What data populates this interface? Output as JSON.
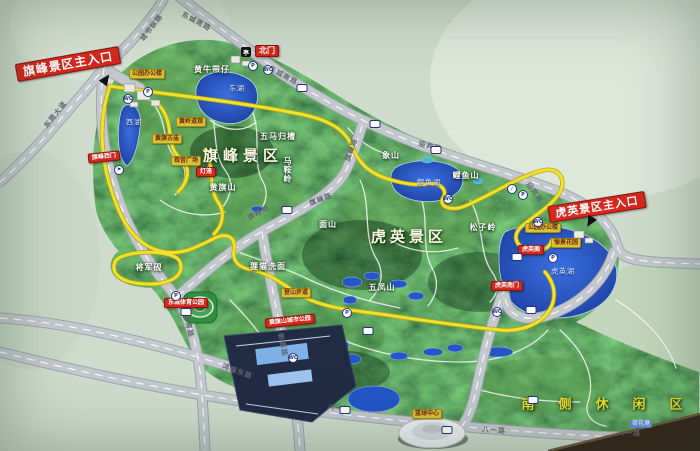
{
  "colors": {
    "background": "#cfdccd",
    "terrain_dark": "#14381a",
    "terrain_mid": "#2b6230",
    "lake_blue": "#2456c8",
    "road_grey": "#c3c8cd",
    "route_yellow": "#efe22a",
    "label_red": "#d3291f",
    "label_yellow": "#d9c233",
    "title_yellow": "#e9dc2e"
  },
  "region_titles": [
    {
      "name": "qifeng-scenic-area-title",
      "text": "旗峰景区",
      "x": 243,
      "y": 156,
      "size": 15,
      "spacing": 5
    },
    {
      "name": "huying-scenic-area-title",
      "text": "虎英景区",
      "x": 409,
      "y": 237,
      "size": 15,
      "spacing": 4
    },
    {
      "name": "south-leisure-area-title",
      "text": "南侧休闲区",
      "x": 614,
      "y": 405,
      "size": 13,
      "spacing": 24,
      "color": "#e9dc2e"
    }
  ],
  "entrance_labels": [
    {
      "name": "qifeng-main-entrance-label",
      "text": "旗峰景区主入口",
      "x": 68,
      "y": 64,
      "size": 12,
      "rot": -10,
      "big": true
    },
    {
      "name": "north-gate-label",
      "text": "北门",
      "x": 267,
      "y": 51,
      "size": 8
    },
    {
      "name": "qifeng-west-gate-label",
      "text": "旗峰西门",
      "x": 104,
      "y": 157,
      "size": 6,
      "rot": -6
    },
    {
      "name": "dongcheng-sports-park-label",
      "text": "东城体育公园",
      "x": 186,
      "y": 303,
      "size": 6
    },
    {
      "name": "huangqishan-city-park-label",
      "text": "黄旗山城市公园",
      "x": 290,
      "y": 321,
      "size": 6,
      "rot": -6
    },
    {
      "name": "huying-main-entrance-label",
      "text": "虎英景区主入口",
      "x": 597,
      "y": 207,
      "size": 11,
      "rot": -9,
      "big": true
    },
    {
      "name": "huying-south-gate-label",
      "text": "虎英南门",
      "x": 507,
      "y": 286,
      "size": 6
    },
    {
      "name": "huying-pavilion-label",
      "text": "虎英阁",
      "x": 531,
      "y": 250,
      "size": 6
    },
    {
      "name": "lantern-label",
      "text": "灯笼",
      "x": 206,
      "y": 172,
      "size": 6
    }
  ],
  "poi_labels": [
    {
      "name": "park-office-label",
      "text": "公园办公楼",
      "x": 147,
      "y": 74
    },
    {
      "name": "huangling-taoist-temple-label",
      "text": "黄岭道观",
      "x": 191,
      "y": 122
    },
    {
      "name": "huangqi-old-temple-label",
      "text": "黄旗古庙",
      "x": 167,
      "y": 139
    },
    {
      "name": "guanyin-square-label",
      "text": "观音广场",
      "x": 186,
      "y": 161
    },
    {
      "name": "hiking-trail-label",
      "text": "登山步道",
      "x": 296,
      "y": 293
    },
    {
      "name": "park-office-east-label",
      "text": "公园办公楼",
      "x": 543,
      "y": 228
    },
    {
      "name": "yujing-garden-label",
      "text": "愉景花园",
      "x": 566,
      "y": 243
    },
    {
      "name": "basketball-center-label",
      "text": "篮球中心",
      "x": 427,
      "y": 414
    }
  ],
  "water_labels": [
    {
      "name": "lotus-pond-label",
      "text": "荷花塘",
      "x": 641,
      "y": 424
    }
  ],
  "terrain_labels": [
    {
      "name": "huangniudaizai-hill-label",
      "text": "黄牛带仔",
      "x": 212,
      "y": 70
    },
    {
      "name": "wuma-guicao-label",
      "text": "五马归槽",
      "x": 278,
      "y": 137
    },
    {
      "name": "maanling-label",
      "text": "马鞍岭",
      "x": 287,
      "y": 170,
      "vertical": true
    },
    {
      "name": "huangqishan-label",
      "text": "黄旗山",
      "x": 223,
      "y": 188
    },
    {
      "name": "jiangjunyan-label",
      "text": "将军砚",
      "x": 149,
      "y": 268
    },
    {
      "name": "limao-ximian-label",
      "text": "狸猫洗面",
      "x": 268,
      "y": 267
    },
    {
      "name": "mianshan-label",
      "text": "面山",
      "x": 328,
      "y": 225
    },
    {
      "name": "xiangshan-label",
      "text": "象山",
      "x": 391,
      "y": 156
    },
    {
      "name": "liyushan-label",
      "text": "鲤鱼山",
      "x": 466,
      "y": 176
    },
    {
      "name": "wufengshan-label",
      "text": "五凤山",
      "x": 382,
      "y": 288
    },
    {
      "name": "songziling-label",
      "text": "松子岭",
      "x": 483,
      "y": 228
    }
  ],
  "lake_labels": [
    {
      "name": "east-lake-label",
      "text": "东湖",
      "x": 237,
      "y": 89
    },
    {
      "name": "west-lake-label",
      "text": "西湖",
      "x": 134,
      "y": 123
    },
    {
      "name": "liyu-lake-label",
      "text": "鲤鱼湖",
      "x": 429,
      "y": 183
    },
    {
      "name": "huying-lake-label",
      "text": "虎英湖",
      "x": 563,
      "y": 272
    }
  ],
  "road_labels": [
    {
      "name": "road-dongchengnan-1",
      "text": "东城南路",
      "x": 196,
      "y": 22,
      "rot": 28
    },
    {
      "name": "road-dongchengnan-2",
      "text": "东城南路",
      "x": 283,
      "y": 76,
      "rot": 28
    },
    {
      "name": "road-chengshuzong",
      "text": "城书纵路",
      "x": 152,
      "y": 28,
      "rot": -52
    },
    {
      "name": "road-dongguan-avenue",
      "text": "东莞大道",
      "x": 56,
      "y": 115,
      "rot": -52
    },
    {
      "name": "road-yingbin-1",
      "text": "迎宾路",
      "x": 430,
      "y": 147,
      "rot": 14
    },
    {
      "name": "road-yingbin-2",
      "text": "迎宾路",
      "x": 534,
      "y": 193,
      "rot": 55
    },
    {
      "name": "road-qifeng-1",
      "text": "旗峰路",
      "x": 259,
      "y": 213,
      "rot": -28
    },
    {
      "name": "road-qifeng-2",
      "text": "旗峰路",
      "x": 321,
      "y": 200,
      "rot": -20
    },
    {
      "name": "road-qifeng-3",
      "text": "旗峰路",
      "x": 352,
      "y": 150,
      "rot": -70
    },
    {
      "name": "road-tiyu",
      "text": "体育路",
      "x": 188,
      "y": 326,
      "rot": 78
    },
    {
      "name": "road-xinyuan",
      "text": "新源路",
      "x": 282,
      "y": 345,
      "rot": 78
    },
    {
      "name": "road-hongfudong",
      "text": "鸿福东路",
      "x": 237,
      "y": 372,
      "rot": 20
    },
    {
      "name": "road-bayi-1",
      "text": "八一路",
      "x": 339,
      "y": 409,
      "rot": 8
    },
    {
      "name": "road-bayi-2",
      "text": "八一路",
      "x": 494,
      "y": 431,
      "rot": 4
    },
    {
      "name": "road-bayi-3",
      "text": "八一路",
      "x": 629,
      "y": 434,
      "rot": 2
    }
  ],
  "icons": [
    {
      "name": "north-gate-icon",
      "kind": "gate",
      "glyph": "亭",
      "x": 246,
      "y": 52
    },
    {
      "name": "parking-icon",
      "kind": "parking",
      "glyph": "P",
      "x": 253,
      "y": 66
    },
    {
      "name": "toilet-icon",
      "kind": "toilet",
      "glyph": "WC",
      "x": 268,
      "y": 70
    },
    {
      "name": "bus-stop-icon",
      "kind": "bus",
      "glyph": "",
      "x": 302,
      "y": 88
    },
    {
      "name": "bus-stop-icon",
      "kind": "bus",
      "glyph": "",
      "x": 375,
      "y": 124
    },
    {
      "name": "bus-stop-icon",
      "kind": "bus",
      "glyph": "",
      "x": 436,
      "y": 150
    },
    {
      "name": "music-fountain-icon",
      "kind": "round",
      "glyph": "♪",
      "x": 512,
      "y": 189
    },
    {
      "name": "parking-icon",
      "kind": "parking",
      "glyph": "P",
      "x": 523,
      "y": 195
    },
    {
      "name": "toilet-icon",
      "kind": "toilet",
      "glyph": "WC",
      "x": 538,
      "y": 222
    },
    {
      "name": "parking-icon",
      "kind": "parking",
      "glyph": "P",
      "x": 553,
      "y": 258
    },
    {
      "name": "bus-stop-icon",
      "kind": "bus",
      "glyph": "",
      "x": 517,
      "y": 257
    },
    {
      "name": "bus-stop-icon",
      "kind": "bus",
      "glyph": "",
      "x": 531,
      "y": 310
    },
    {
      "name": "entrance-arrow-icon",
      "kind": "arrow",
      "glyph": "",
      "x": 590,
      "y": 222,
      "rot": 210
    },
    {
      "name": "entrance-arrow-icon",
      "kind": "arrow",
      "glyph": "",
      "x": 106,
      "y": 79,
      "rot": 35
    },
    {
      "name": "viewpoint-flag-icon",
      "kind": "round",
      "glyph": "⚑",
      "x": 119,
      "y": 170
    },
    {
      "name": "toilet-icon",
      "kind": "toilet",
      "glyph": "WC",
      "x": 128,
      "y": 99
    },
    {
      "name": "parking-icon",
      "kind": "parking",
      "glyph": "P",
      "x": 148,
      "y": 92
    },
    {
      "name": "parking-icon",
      "kind": "parking",
      "glyph": "P",
      "x": 176,
      "y": 296
    },
    {
      "name": "bus-stop-icon",
      "kind": "bus",
      "glyph": "",
      "x": 186,
      "y": 312
    },
    {
      "name": "parking-icon",
      "kind": "parking",
      "glyph": "P",
      "x": 347,
      "y": 313
    },
    {
      "name": "bus-stop-icon",
      "kind": "bus",
      "glyph": "",
      "x": 368,
      "y": 331
    },
    {
      "name": "toilet-icon",
      "kind": "toilet",
      "glyph": "WC",
      "x": 293,
      "y": 358
    },
    {
      "name": "bus-stop-icon",
      "kind": "bus",
      "glyph": "",
      "x": 345,
      "y": 410
    },
    {
      "name": "bus-stop-icon",
      "kind": "bus",
      "glyph": "",
      "x": 447,
      "y": 430
    },
    {
      "name": "toilet-icon",
      "kind": "toilet",
      "glyph": "WC",
      "x": 497,
      "y": 312
    },
    {
      "name": "bus-stop-icon",
      "kind": "bus",
      "glyph": "",
      "x": 533,
      "y": 400
    },
    {
      "name": "bus-stop-icon",
      "kind": "bus",
      "glyph": "",
      "x": 287,
      "y": 210
    },
    {
      "name": "toilet-icon",
      "kind": "toilet",
      "glyph": "WC",
      "x": 448,
      "y": 199
    }
  ]
}
